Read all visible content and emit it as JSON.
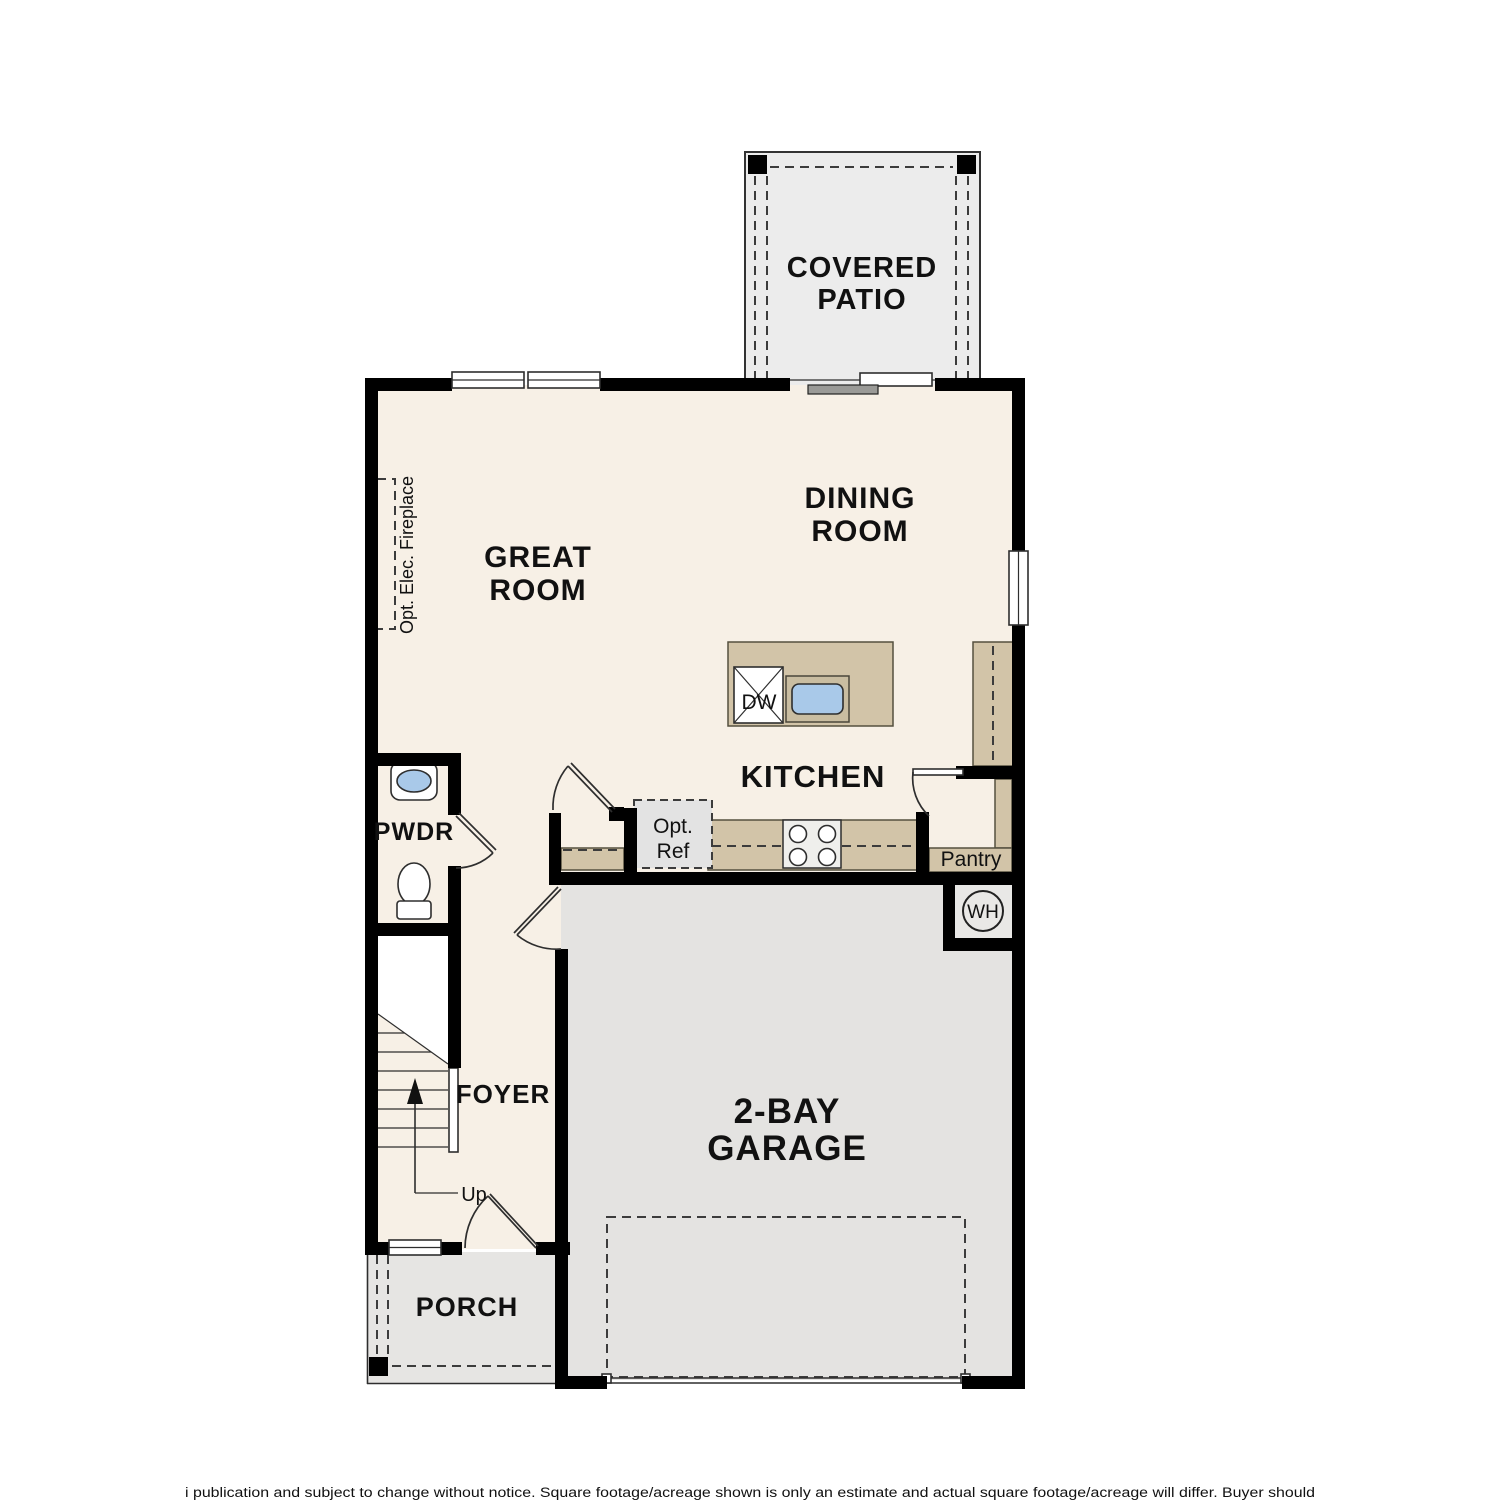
{
  "plan": {
    "colors": {
      "wall": "#000000",
      "interior_floor": "#f7f0e6",
      "garage_floor": "#e4e3e1",
      "patio_floor": "#ececec",
      "porch_floor": "#e6e5e3",
      "counter": "#d2c4a8",
      "sink_basin": "#a9c9e9",
      "opt_ref_box": "#e3e3e3"
    },
    "rooms": {
      "covered_patio": {
        "line1": "COVERED",
        "line2": "PATIO"
      },
      "dining": {
        "line1": "DINING",
        "line2": "ROOM"
      },
      "great": {
        "line1": "GREAT",
        "line2": "ROOM"
      },
      "kitchen": {
        "label": "KITCHEN"
      },
      "pwdr": {
        "label": "PWDR"
      },
      "foyer": {
        "label": "FOYER"
      },
      "garage": {
        "line1": "2-BAY",
        "line2": "GARAGE"
      },
      "porch": {
        "label": "PORCH"
      },
      "pantry": {
        "label": "Pantry"
      }
    },
    "fixtures": {
      "dishwasher": "DW",
      "opt_ref_line1": "Opt.",
      "opt_ref_line2": "Ref",
      "water_heater": "WH",
      "fireplace": "Opt. Elec. Fireplace",
      "stairs_up": "Up"
    },
    "disclaimer": "i publication and subject to change without notice. Square footage/acreage shown is only an estimate and actual square footage/acreage will differ. Buyer should"
  }
}
